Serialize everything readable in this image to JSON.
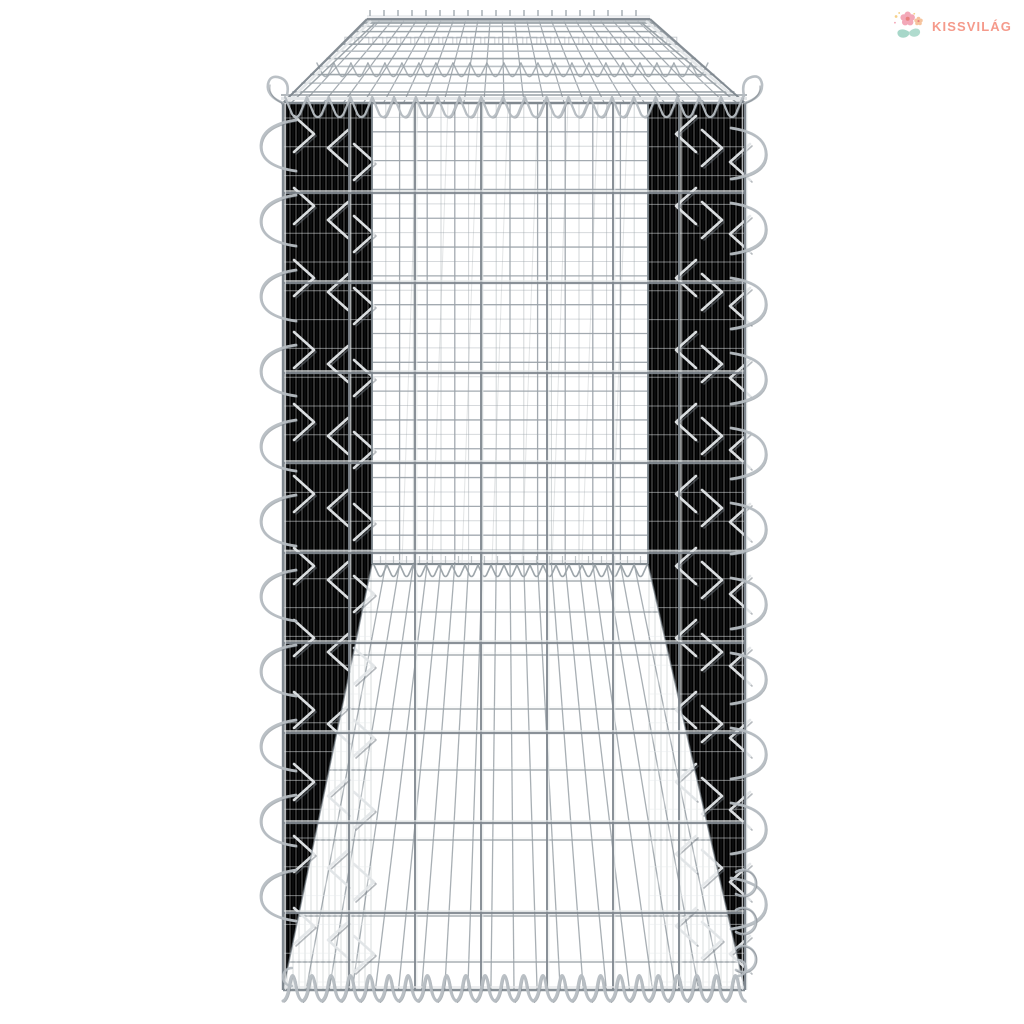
{
  "page": {
    "background": "#ffffff"
  },
  "brand": {
    "name": "KISSVILÁG",
    "text_color": "#F59A8B",
    "flower_pink": "#F3A8B8",
    "flower_center": "#E8807E",
    "flower_peach": "#F6C49E",
    "leaf_teal": "#A7D7C9",
    "sparkle_yellow": "#F5D189"
  },
  "product_image": {
    "description": "Empty galvanised silver gabion basket with cover, viewed from the end; wire mesh cage with spiral binders on all edges",
    "finish": "galvanised silver",
    "colors": {
      "wire_bright": "#e4e7e9",
      "wire_light": "#b6bdc2",
      "wire_mid": "#99a1a7",
      "wire_dark": "#80888f",
      "wire_shadow": "#6e767d",
      "panel_light": "#bcc3c8",
      "panel_mid": "#acb4b9",
      "panel_dark": "#9aa2a8"
    }
  }
}
